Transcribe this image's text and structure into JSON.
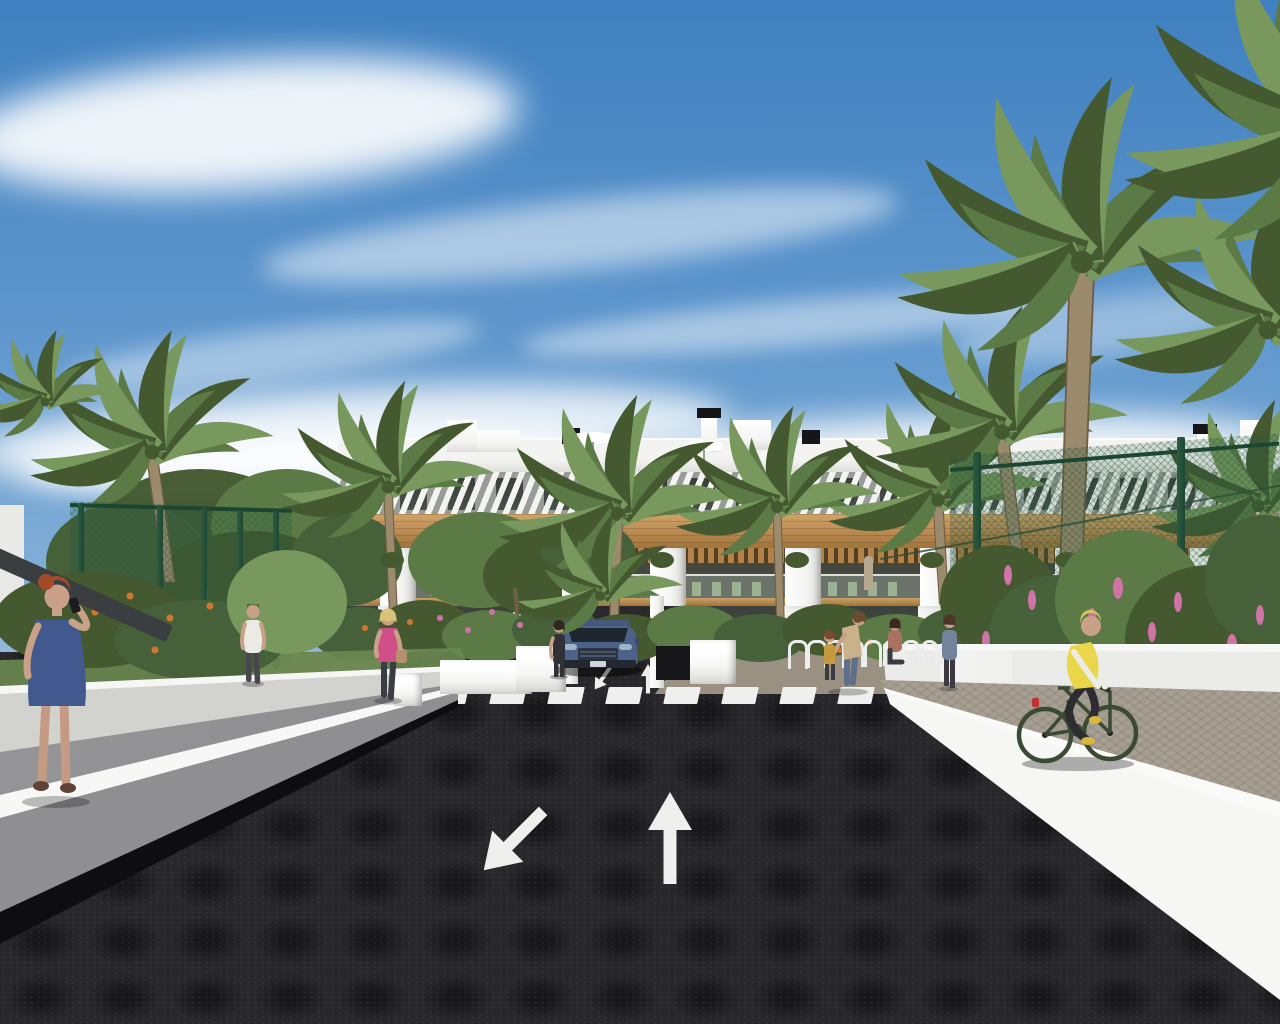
{
  "scene": {
    "description": "3D architectural rendering of a modern white two-storey apartment complex with wood accents, palm trees, landscaped gardens, a dark asphalt entrance road with up and down-left lane arrows, a zebra crossing, a parked grey-blue SUV, pedestrians and a cyclist on a side path",
    "colors": {
      "sky_top": "#3f80c0",
      "sky_mid": "#7fadd6",
      "sky_horizon": "#d3dfe8",
      "cloud": "#ffffff",
      "facade": "#f3f3f1",
      "facade_shade": "#dedfdb",
      "glass_dark": "#30362f",
      "glass_green": "#49544c",
      "wood": "#c0915a",
      "wood_dark": "#9f7439",
      "balcony_dark": "#44483f",
      "furniture_green": "#a3bd99",
      "hedge": "#46603a",
      "leaf": "#5b7a45",
      "leaf_light": "#78985e",
      "leaf_dark": "#44592f",
      "trunk": "#9b8a6b",
      "trunk_dark": "#6f5f46",
      "grass": "#6a8a50",
      "flower_orange": "#d2782e",
      "flower_pink": "#cf74a6",
      "fence_green": "#1d4632",
      "road": "#28272b",
      "road_mark": "#efefed",
      "ramp_grey": "#97979a",
      "wall_grey": "#8f8f92",
      "wall_white": "#ebebe9",
      "wall_bright": "#f6f6f4",
      "wall_shade": "#d2d2cf",
      "shadow_dark": "#0e0e10",
      "path_warm": "#a79f92",
      "skin": "#c9a188",
      "hair_red": "#a34b28",
      "dress_blue": "#41598f",
      "pink_top": "#cf5088",
      "vest_yellow": "#e9d64b",
      "mustard": "#c59a3f",
      "denim": "#73839b",
      "tan_top": "#c9b289",
      "car_blue": "#4d6289",
      "car_dark": "#2c3a52",
      "bike_green": "#3a4a34",
      "canopy_dark": "#3b3e41"
    },
    "building": {
      "window_count": 19,
      "window_start_x": 352,
      "window_gap": 48,
      "window_width": 27,
      "pillars_x": [
        380,
        515,
        650,
        785,
        920,
        1055,
        1190
      ],
      "furniture_x": [
        430,
        692,
        828,
        962,
        1198
      ],
      "balcony_people": [
        {
          "x": 616,
          "color": "#9ab890"
        },
        {
          "x": 864,
          "color": "#b8a890"
        },
        {
          "x": 1150,
          "color": "#c8c0b0"
        },
        {
          "x": 1163,
          "color": "#d8d060"
        }
      ]
    },
    "crosswalk": {
      "stripe_count": 8,
      "start_x": 433,
      "gap": 58
    },
    "road_arrows": [
      {
        "direction": "down-left"
      },
      {
        "direction": "up"
      }
    ],
    "mini_arrows": [
      {
        "direction": "down-left"
      },
      {
        "direction": "up"
      }
    ],
    "bike_racks": {
      "count": 9,
      "start_x": 788,
      "gap": 19,
      "y": 640
    },
    "fences": {
      "left_posts_x": [
        78,
        157,
        201,
        237,
        273
      ],
      "right_posts": [
        {
          "x": 973,
          "y": 452,
          "h": 248
        },
        {
          "x": 1177,
          "y": 437,
          "h": 253
        }
      ]
    },
    "palms": [
      {
        "x": 152,
        "y": 452,
        "s": 135,
        "t": 130,
        "tl": 18,
        "tw": 9,
        "z": 21
      },
      {
        "x": 45,
        "y": 402,
        "s": 80,
        "z": 21
      },
      {
        "x": 388,
        "y": 487,
        "s": 118,
        "t": 140,
        "tl": 6,
        "tw": 8,
        "z": 21
      },
      {
        "x": 618,
        "y": 514,
        "s": 132,
        "t": 108,
        "tl": -4,
        "tw": 8,
        "z": 21
      },
      {
        "x": 600,
        "y": 596,
        "s": 92,
        "z": 28
      },
      {
        "x": 777,
        "y": 507,
        "s": 112,
        "t": 130,
        "tl": 4,
        "tw": 8,
        "z": 21
      },
      {
        "x": 938,
        "y": 500,
        "s": 122,
        "t": 104,
        "tl": 6,
        "tw": 9,
        "z": 21
      },
      {
        "x": 1002,
        "y": 432,
        "s": 140,
        "t": 130,
        "tl": 16,
        "tw": 10,
        "z": 21
      },
      {
        "x": 1082,
        "y": 262,
        "s": 205,
        "t": 340,
        "tl": -12,
        "tw": 13,
        "z": 21
      },
      {
        "x": 1268,
        "y": 330,
        "s": 170,
        "z": 21
      },
      {
        "x": 1332,
        "y": 140,
        "s": 230,
        "z": 21
      },
      {
        "x": 1258,
        "y": 506,
        "s": 118,
        "z": 21
      }
    ],
    "clouds": [
      {
        "x": -40,
        "y": 60,
        "w": 560,
        "h": 130,
        "rot": -4,
        "op": 0.9,
        "blur": 18
      },
      {
        "x": 260,
        "y": 200,
        "w": 640,
        "h": 70,
        "rot": -6,
        "op": 0.5,
        "blur": 12
      },
      {
        "x": 520,
        "y": 300,
        "w": 560,
        "h": 46,
        "rot": -5,
        "op": 0.45,
        "blur": 10
      },
      {
        "x": 60,
        "y": 330,
        "w": 420,
        "h": 50,
        "rot": -7,
        "op": 0.4,
        "blur": 10
      },
      {
        "x": -30,
        "y": 388,
        "w": 760,
        "h": 95,
        "rot": -3,
        "op": 0.8,
        "blur": 16
      },
      {
        "x": 600,
        "y": 415,
        "w": 680,
        "h": 75,
        "rot": -2,
        "op": 0.85,
        "blur": 16
      },
      {
        "x": 20,
        "y": 428,
        "w": 580,
        "h": 62,
        "rot": -2,
        "op": 0.85,
        "blur": 14
      },
      {
        "x": 950,
        "y": 295,
        "w": 330,
        "h": 60,
        "rot": -8,
        "op": 0.35,
        "blur": 12
      }
    ],
    "people": [
      {
        "id": "woman-blue-dress",
        "detail": "red-haired woman in a blue dress talking on a phone, left walkway"
      },
      {
        "id": "woman-pink-top",
        "detail": "blonde woman in pink top with handbag walking on garden path"
      },
      {
        "id": "man-white-shirt",
        "detail": "man in white t-shirt walking away on left path"
      },
      {
        "id": "woman-by-car",
        "detail": "woman in dark jumpsuit standing beside the parked SUV"
      },
      {
        "id": "woman-tan-with-child",
        "detail": "woman leaning toward a child near the bike racks"
      },
      {
        "id": "seated-woman",
        "detail": "woman seated near the bike racks"
      },
      {
        "id": "person-denim",
        "detail": "person in denim jacket on the right path"
      },
      {
        "id": "cyclist",
        "detail": "cyclist in yellow vest riding a green bicycle on the right side path"
      }
    ],
    "vehicle": {
      "id": "suv",
      "detail": "grey-blue SUV parked facing the road at the driveway"
    }
  }
}
